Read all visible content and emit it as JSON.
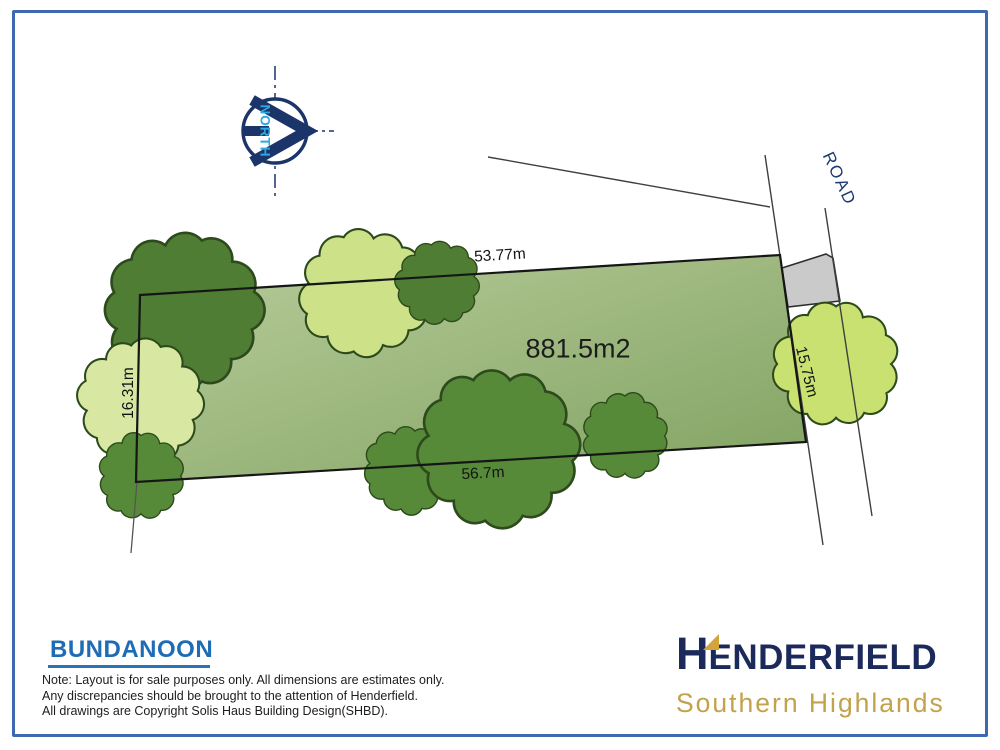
{
  "plan": {
    "north_label": "NORTH",
    "road_label": "ROAD",
    "area_label": "881.5m2",
    "dimensions": {
      "top": "53.77m",
      "bottom": "56.7m",
      "left": "16.31m",
      "right": "15.75m"
    }
  },
  "title_block": {
    "suburb": "BUNDANOON",
    "note_line1": "Note: Layout is for sale purposes only. All dimensions are estimates only.",
    "note_line2": "Any discrepancies should be brought to the attention of Henderfield.",
    "note_line3": "All drawings are Copyright Solis Haus Building Design(SHBD)."
  },
  "brand": {
    "name_initial": "H",
    "name_rest": "ENDERFIELD",
    "tagline": "Southern Highlands"
  },
  "colors": {
    "frame_border": "#3e68b0",
    "lot_fill_light": "#b9cc9b",
    "lot_fill_dark": "#81a362",
    "lot_outline": "#161616",
    "tree_dark_green": "#4e7d33",
    "tree_mid_green": "#568a39",
    "tree_light_green": "#d8e7a2",
    "tree_road_green": "#c9e170",
    "driveway_gray": "#cacaca",
    "compass_navy": "#1b356b",
    "north_cyan": "#2da9e1",
    "road_text_navy": "#1b3a6e",
    "suburb_blue": "#1e6cb5",
    "brand_navy": "#1b2a5a",
    "brand_gold": "#c3a24c"
  }
}
